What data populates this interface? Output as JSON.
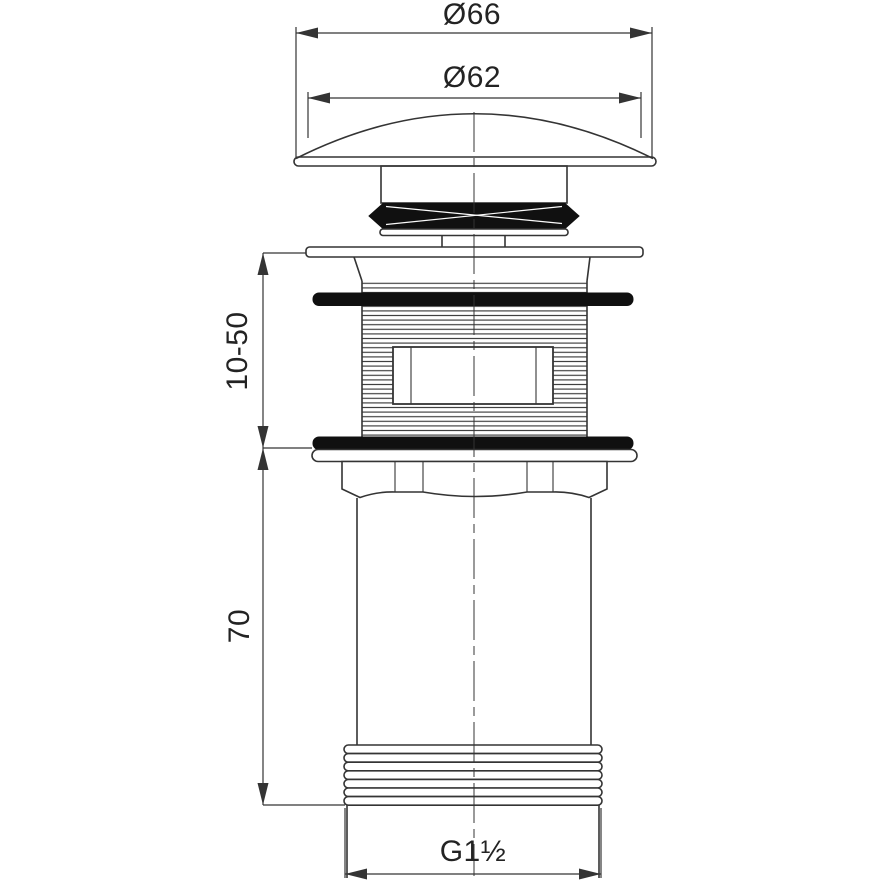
{
  "drawing": {
    "title": "pop-up basin waste fitting - dimensioned technical drawing",
    "labels": {
      "cap_outer_diameter": "Ø66",
      "cap_face_diameter": "Ø62",
      "clamping_range": "10-50",
      "tailpiece_length": "70",
      "outlet_thread": "G1½"
    },
    "colors": {
      "bg": "#ffffff",
      "line": "#343434",
      "seal": "#101010",
      "text": "#232323"
    }
  }
}
